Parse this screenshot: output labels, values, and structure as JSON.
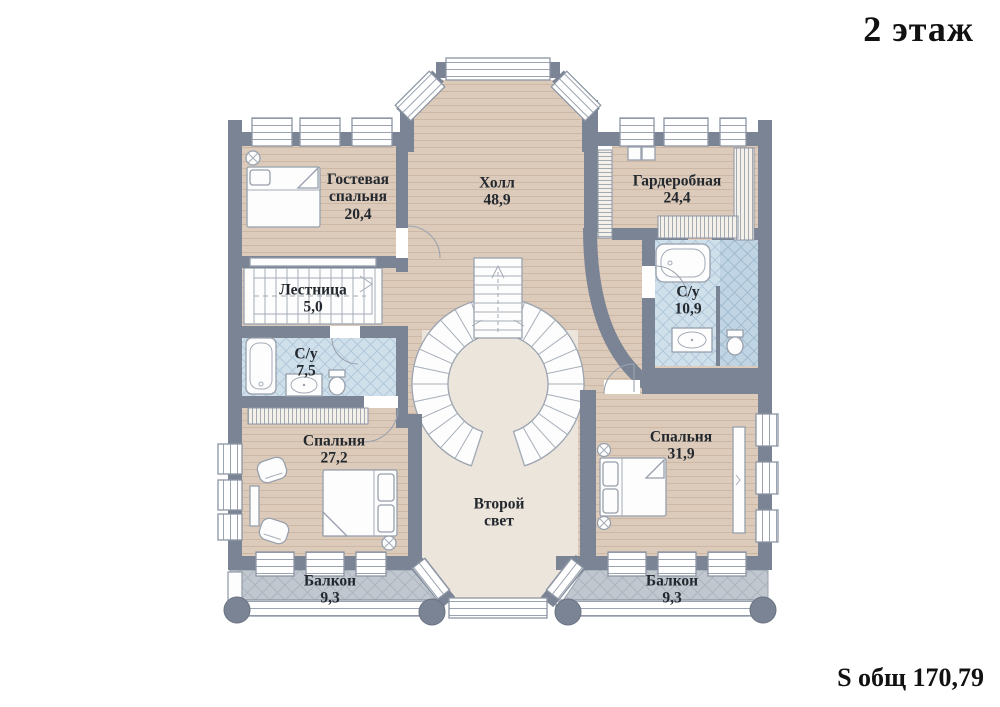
{
  "title": "2 этаж",
  "footer": {
    "total_area": "S общ 170,79"
  },
  "plan": {
    "floor_number": "2",
    "total_area_value": "170,79",
    "rooms": [
      {
        "id": "guest-bedroom",
        "name": "Гостевая спальня",
        "area": "20,4"
      },
      {
        "id": "hall",
        "name": "Холл",
        "area": "48,9"
      },
      {
        "id": "wardrobe",
        "name": "Гардеробная",
        "area": "24,4"
      },
      {
        "id": "bathroom-right",
        "name": "С/у",
        "area": "10,9"
      },
      {
        "id": "staircase",
        "name": "Лестница",
        "area": "5,0"
      },
      {
        "id": "bathroom-left",
        "name": "С/у",
        "area": "7,5"
      },
      {
        "id": "bedroom-left",
        "name": "Спальня",
        "area": "27,2"
      },
      {
        "id": "bedroom-right",
        "name": "Спальня",
        "area": "31,9"
      },
      {
        "id": "second-light",
        "name": "Второй свет",
        "area": ""
      },
      {
        "id": "balcony-left",
        "name": "Балкон",
        "area": "9,3"
      },
      {
        "id": "balcony-right",
        "name": "Балкон",
        "area": "9,3"
      }
    ],
    "colors": {
      "wall": "#7b8494",
      "wood_floor": "#dccbbb",
      "wood_stripe": "#cdb8a6",
      "second_light_floor": "#ece5db",
      "bath_tile": "#cfe0eb",
      "shower_tile": "#c0d4e3",
      "balcony_tile": "#c0c7cf",
      "text": "#23282e"
    }
  }
}
